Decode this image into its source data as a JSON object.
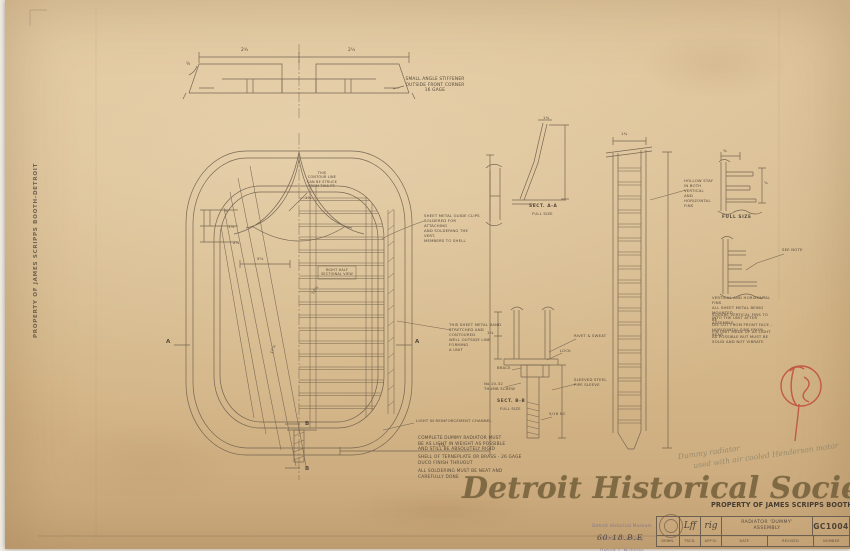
{
  "page": {
    "left_edge_stamp": "PROPERTY OF JAMES SCRIPPS BOOTH-DETROIT",
    "watermark": "Detroit Historical Society",
    "property_stamp": "PROPERTY OF JAMES SCRIPPS BOOTH-DETROIT"
  },
  "top_view": {
    "corner_note": "SMALL ANGLE STIFFENER\nOUTSIDE FRONT CORNER\n16 GAGE",
    "dim_left": "2¾",
    "dim_right": "2¼",
    "dim_end": "¾"
  },
  "front_view": {
    "contour_note": "THIS\nCONTOUR LINE\nCAN BE STRUCK\nFROM THIS PT.",
    "clips_note": "SHEET METAL GUIDE CLIPS\nSOLDERED FOR ATTACHING\nAND SOLDERING THE VERT.\nMEMBERS TO SHELL",
    "band_note": "THIS SHEET METAL BAND\nSTRETCHED AND CONTOURED\nWELL OUTSIDE LINE FORMING\nA UNIT",
    "half_note": "RIGHT HALF\nSECTIONAL VIEW",
    "channel_note": "LIGHT IN REINFORCEMENT CHANNEL",
    "marker_a_left": "A",
    "marker_a_right": "A",
    "marker_b_top": "B",
    "marker_b_bottom": "B",
    "dims": {
      "d1": "⅞",
      "d2": "1⅝",
      "d3": "2⅞",
      "d4": "9⅝",
      "d5": "12⅞",
      "d6": "17⅞",
      "d7": "7⅞",
      "d8": "1⅝"
    }
  },
  "notes_block": {
    "para1": "COMPLETE DUMMY RADIATOR MUST\nBE AS LIGHT IN WEIGHT AS POSSIBLE\nAND STILL BE ABSOLUTELY RIGID",
    "para2": "SHELL OF TERNEPLATE OR BRASS - 26 GAGE\nDUCO FINISH THRUOUT",
    "para3": "ALL SOLDERING MUST BE NEAT AND\nCAREFULLY DONE"
  },
  "sect_aa": {
    "title": "SECT. A-A",
    "subtitle": "FULL SIZE",
    "dim_top": "1¾"
  },
  "sect_bb": {
    "title": "SECT. B-B",
    "subtitle": "FULL SIZE",
    "callout_rivet": "RIVET & SWEAT",
    "callout_lock": "LOCK",
    "callout_brace": "BRACE",
    "callout_screw": "No.10-32\nTHUMB SCREW",
    "callout_sleeve": "SLEEVED STEEL\nPIPE SLEEVE",
    "callout_nc": "5/16 NC",
    "dim_left": "1⅛"
  },
  "side_view": {
    "hollow_note": "HOLLOW STAY\nIN BOTH VERTICAL\nAND HORIZONTAL\nFINS",
    "dim_top": "1¾"
  },
  "right_details": {
    "full_size_label": "FULL SIZE",
    "see_note": "SEE NOTE",
    "dim_a": "⅝",
    "dim_b": "⅜",
    "para1": "VERTICAL AND HORIZONTAL FINS\nALL SHEET METAL BEING MOUNTED\nINTO THE UNIT AFTER ASSEMBLY",
    "para2": "SQUARE VERTICAL FINS TO BE\nDIE CUT FROM FRONT FACE -\nHORIZONTAL FINS FROM REAR",
    "para3": "FIN UNIT MADE UP AS LIGHT\nAS POSSIBLE BUT MUST BE\nSOLID AND NOT VIBRATE"
  },
  "stamps": {
    "accession_line1": "Detroit Historical Museum",
    "accession_line2": "Woodward at Kirby",
    "accession_line3": "Detroit 2, Michigan",
    "accession_number": "60-18.B.E"
  },
  "title_block": {
    "title": "RADIATOR 'DUMMY'\nASSEMBLY",
    "number": "GC1004",
    "sig1": "Lff",
    "sig2": "rig",
    "labels": {
      "drwn": "DRWN.",
      "trcd": "TRCD.",
      "appd": "APP'D.",
      "date": "DATE",
      "revised": "REVISED",
      "number": "NUMBER"
    }
  },
  "pencil_note": {
    "line1": "Dummy radiator",
    "line2": "used with air cooled Henderson motor"
  },
  "colors": {
    "paper": "#d9bd92",
    "ink": "#6b5d4b",
    "red_mark": "#bf4434",
    "purple_stamp": "#80718e",
    "watermark": "#6f5c38"
  }
}
